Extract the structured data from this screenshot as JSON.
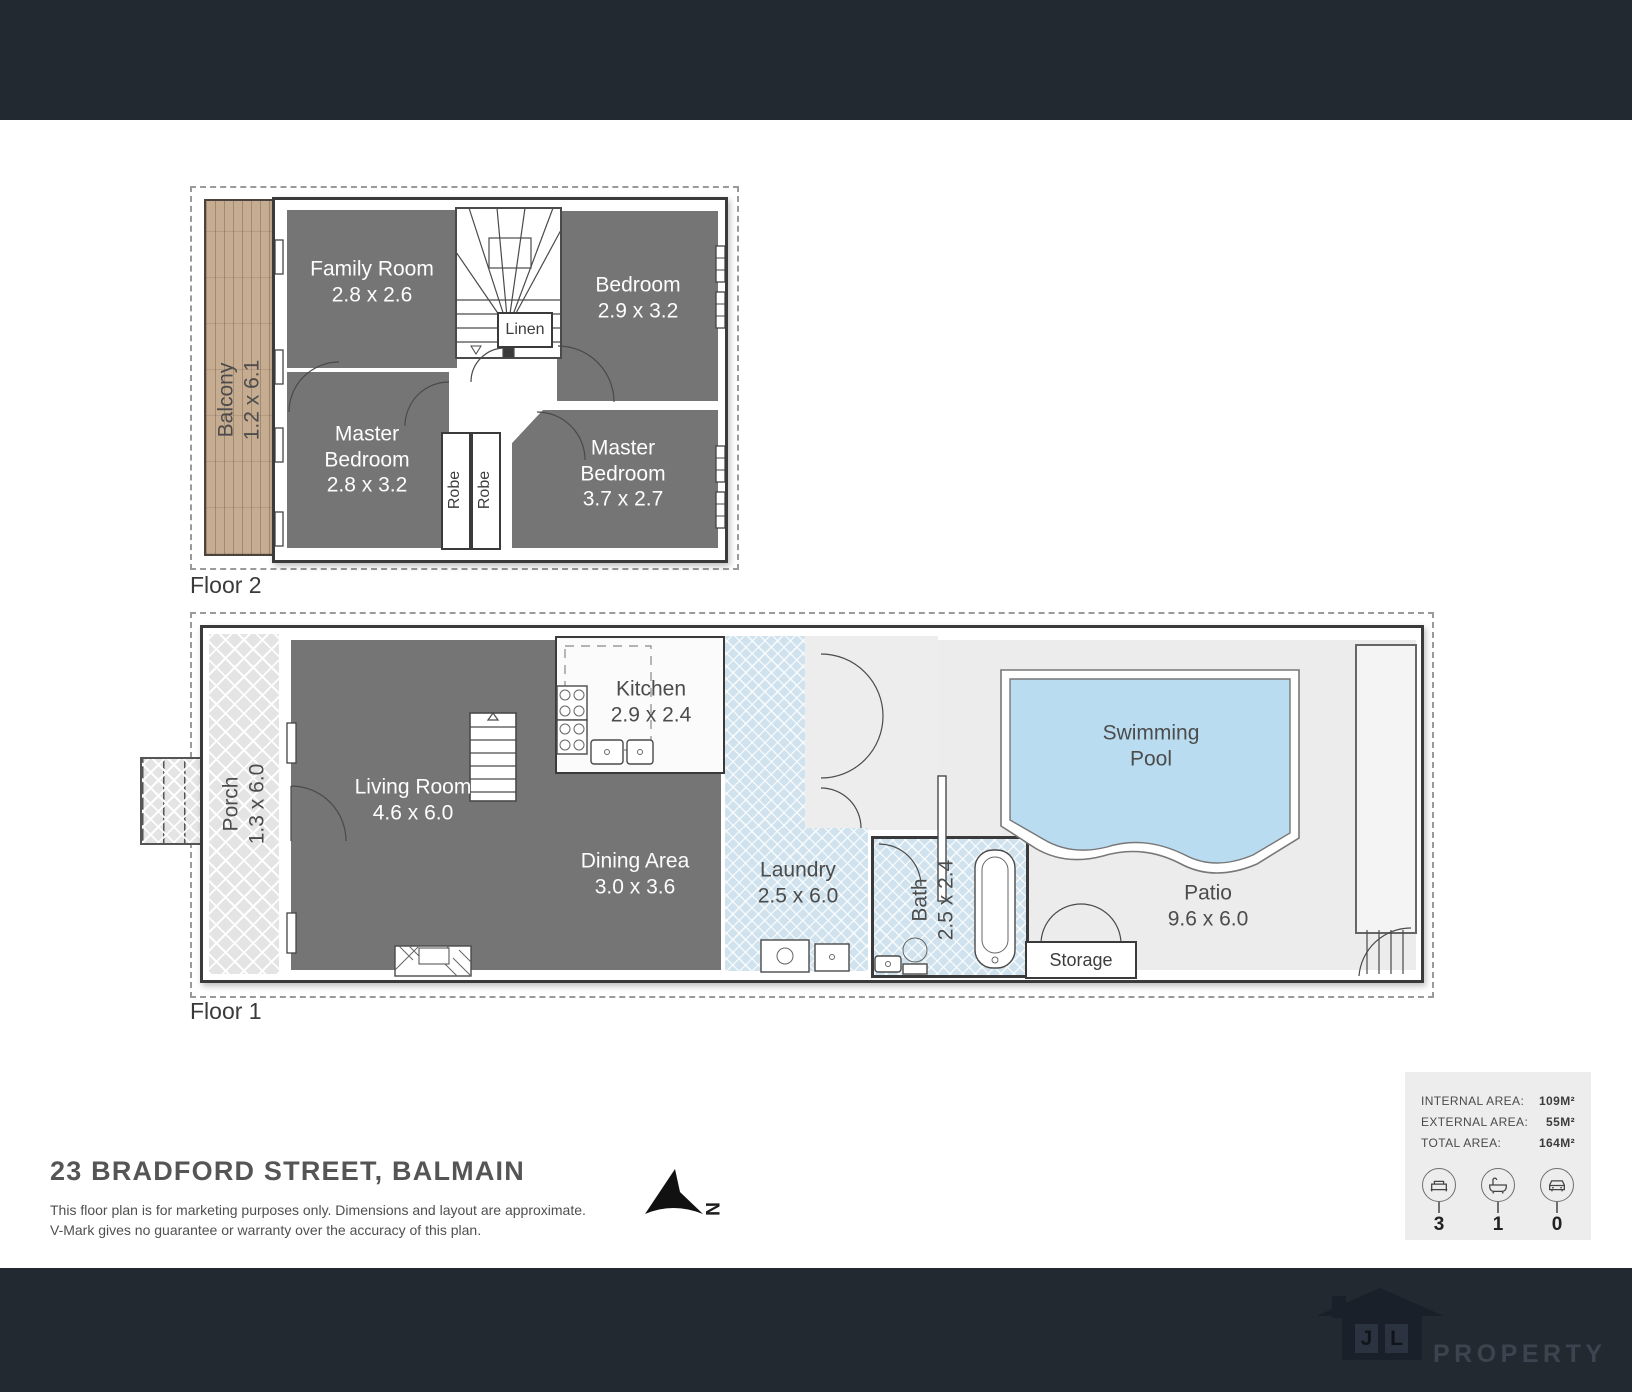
{
  "colors": {
    "top_bar": "#232931",
    "bottom_bar": "#232931",
    "room_gray": "#757575",
    "pool_blue": "#badcf0",
    "wet_area_blue": "#cfe2ed",
    "balcony_wood": "#c6ac91",
    "patio_gray": "#ececec"
  },
  "floor2": {
    "label": "Floor 2",
    "balcony_name": "Balcony",
    "balcony_dims": "1.2 x 6.1",
    "family_room_name": "Family Room",
    "family_room_dims": "2.8 x 2.6",
    "bedroom_name": "Bedroom",
    "bedroom_dims": "2.9 x 3.2",
    "master_left_name": "Master Bedroom",
    "master_left_dims": "2.8 x 3.2",
    "master_right_name": "Master Bedroom",
    "master_right_dims": "3.7 x 2.7",
    "linen": "Linen",
    "robe_1": "Robe",
    "robe_2": "Robe"
  },
  "floor1": {
    "label": "Floor 1",
    "porch_name": "Porch",
    "porch_dims": "1.3 x 6.0",
    "living_name": "Living Room",
    "living_dims": "4.6 x 6.0",
    "kitchen_name": "Kitchen",
    "kitchen_dims": "2.9 x 2.4",
    "dining_name": "Dining Area",
    "dining_dims": "3.0 x 3.6",
    "laundry_name": "Laundry",
    "laundry_dims": "2.5 x 6.0",
    "bath_name": "Bath",
    "bath_dims": "2.5 x 2.4",
    "pool_name": "Swimming Pool",
    "patio_name": "Patio",
    "patio_dims": "9.6 x 6.0",
    "storage": "Storage"
  },
  "footer": {
    "title": "23 BRADFORD STREET, BALMAIN",
    "disclaimer_1": "This floor plan is for marketing purposes only. Dimensions and layout are approximate.",
    "disclaimer_2": "V-Mark gives no guarantee or warranty over the accuracy of this plan.",
    "north_label": "N"
  },
  "info_box": {
    "rows": [
      {
        "label": "INTERNAL AREA:",
        "value": "109M²"
      },
      {
        "label": "EXTERNAL AREA:",
        "value": "55M²"
      },
      {
        "label": "TOTAL AREA:",
        "value": "164M²"
      }
    ],
    "beds": "3",
    "baths": "1",
    "cars": "0"
  },
  "logo": {
    "initial_j": "J",
    "initial_l": "L",
    "brand": "PROPERTY"
  }
}
